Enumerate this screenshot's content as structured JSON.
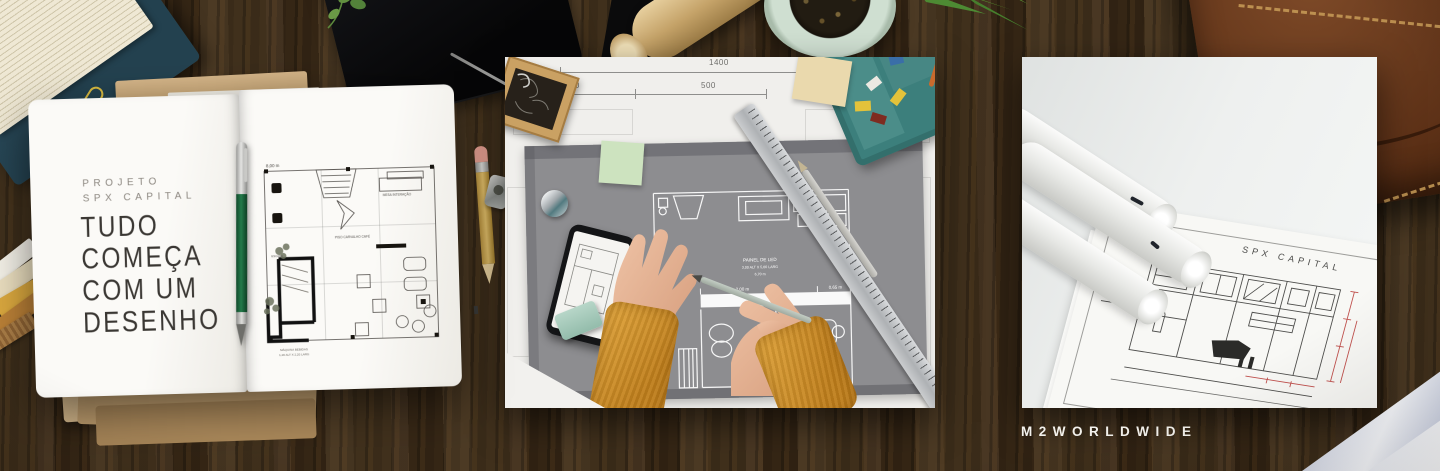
{
  "brand": {
    "wordmark": "M2WORLDWIDE"
  },
  "notebook": {
    "eyebrow_line1": "PROJETO",
    "eyebrow_line2": "SPX CAPITAL",
    "heading_line1": "TUDO",
    "heading_line2": "COMEÇA",
    "heading_line3": "COM UM",
    "heading_line4": "DESENHO"
  },
  "floor_plan_sketch": {
    "dim_height": "8,00 m",
    "label_desk": "MESA INTERAÇÃO",
    "label_floor": "PISO CARVALHO CAFÉ",
    "label_stairs": "ESCADA",
    "caption_line1": "MÁQUINA BEBIDAS",
    "caption_line2": "1,20 ALT X 2,20 LARG"
  },
  "blueprint_photo": {
    "dim_total": "1400",
    "dim_left": "300",
    "dim_right": "500",
    "panel_label_line1": "PAINEL DE LED",
    "panel_label_line2": "3,00 ALT X 5,00 LARG",
    "panel_label_line3": "6,70 m",
    "corridor_dim_left": "2,00 m",
    "corridor_dim_right": "0,65 m"
  },
  "drawing_sheet_photo": {
    "sheet_title": "SPX CAPITAL"
  },
  "colors": {
    "desk_wood": "#3d2d1a",
    "accent_teal": "#3c7f7c",
    "sweater_mustard": "#d8992f",
    "pen_green": "#1e6b40",
    "mat_gray": "#8d8d90",
    "dimension_red": "#c0504d",
    "kraft": "#c9a878",
    "brand_text": "#f3f1ec"
  }
}
